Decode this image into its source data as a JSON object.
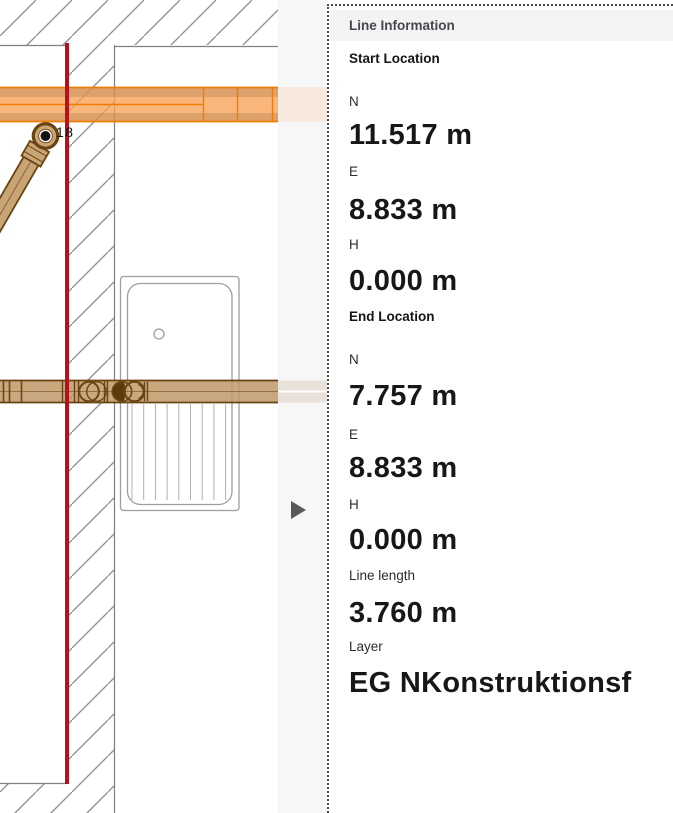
{
  "panel": {
    "title": "Line Information",
    "start_section": "Start Location",
    "end_section": "End Location",
    "start": {
      "n_label": "N",
      "n_value": "11.517 m",
      "e_label": "E",
      "e_value": "8.833 m",
      "h_label": "H",
      "h_value": "0.000 m"
    },
    "end": {
      "n_label": "N",
      "n_value": "7.757 m",
      "e_label": "E",
      "e_value": "8.833 m",
      "h_label": "H",
      "h_value": "0.000 m"
    },
    "line_length_label": "Line length",
    "line_length_value": "3.760 m",
    "layer_label": "Layer",
    "layer_value": "EG NKonstruktionsf"
  },
  "drawing": {
    "endpoint_label": "18",
    "icons": {
      "expand_arrow": "right-pointing-triangle"
    }
  },
  "colors": {
    "section_line_red": "#b5121c",
    "duct_orange_border": "#ee7d05",
    "duct_orange_fill": "#f7a055",
    "pipe_brown_border": "#6b4413",
    "pipe_brown_fill": "#bf9869",
    "hatch_gray": "#909090",
    "strip_gray": "#f7f7f7",
    "header_band_gray": "#f3f3f3",
    "arrow_gray": "#58595b"
  }
}
